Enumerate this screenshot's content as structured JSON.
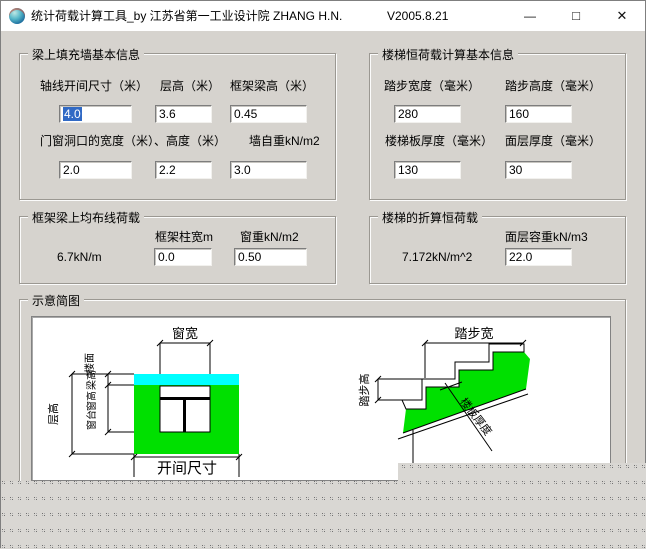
{
  "window": {
    "title": "统计荷载计算工具_by 江苏省第一工业设计院 ZHANG H.N.",
    "version": "V2005.8.21",
    "minimize_glyph": "—",
    "maximize_glyph": "□",
    "close_glyph": "✕"
  },
  "g1": {
    "title": "梁上填充墙基本信息",
    "f1": {
      "label": "轴线开间尺寸（米）",
      "value": "4.0"
    },
    "f2": {
      "label": "层高（米）",
      "value": "3.6"
    },
    "f3": {
      "label": "框架梁高（米）",
      "value": "0.45"
    },
    "row2a": "门窗洞口的宽度（米）、高度（米）",
    "row2b": "墙自重kN/m2",
    "f4": {
      "value": "2.0"
    },
    "f5": {
      "value": "2.2"
    },
    "f6": {
      "value": "3.0"
    }
  },
  "g2": {
    "title": "楼梯恒荷载计算基本信息",
    "f1": {
      "label": "踏步宽度（毫米）",
      "value": "280"
    },
    "f2": {
      "label": "踏步高度（毫米）",
      "value": "160"
    },
    "f3": {
      "label": "楼梯板厚度（毫米）",
      "value": "130"
    },
    "f4": {
      "label": "面层厚度（毫米）",
      "value": "30"
    }
  },
  "g3": {
    "title": "框架梁上均布线荷载",
    "result": "6.7kN/m",
    "f1": {
      "label": "框架柱宽m",
      "value": "0.0"
    },
    "f2": {
      "label": "窗重kN/m2",
      "value": "0.50"
    }
  },
  "g4": {
    "title": "楼梯的折算恒荷载",
    "result": "7.172kN/m^2",
    "f1": {
      "label": "面层容重kN/m3",
      "value": "22.0"
    }
  },
  "g5": {
    "title": "示意简图"
  },
  "diag": {
    "win_width": "窗宽",
    "bay": "开间尺寸",
    "floor_h": "层高",
    "floor_line": "楼面",
    "beam_h": "梁高",
    "win_h": "窗高",
    "win_sill": "窗台",
    "step_w": "踏步宽",
    "step_h": "踏步高",
    "slab_t": "楼板厚度"
  },
  "colors": {
    "selection": "#316ac5",
    "green": "#00e000",
    "cyan": "#00ffff",
    "form_bg": "#d6d3ce",
    "titlebar_bg": "#ffffff"
  }
}
